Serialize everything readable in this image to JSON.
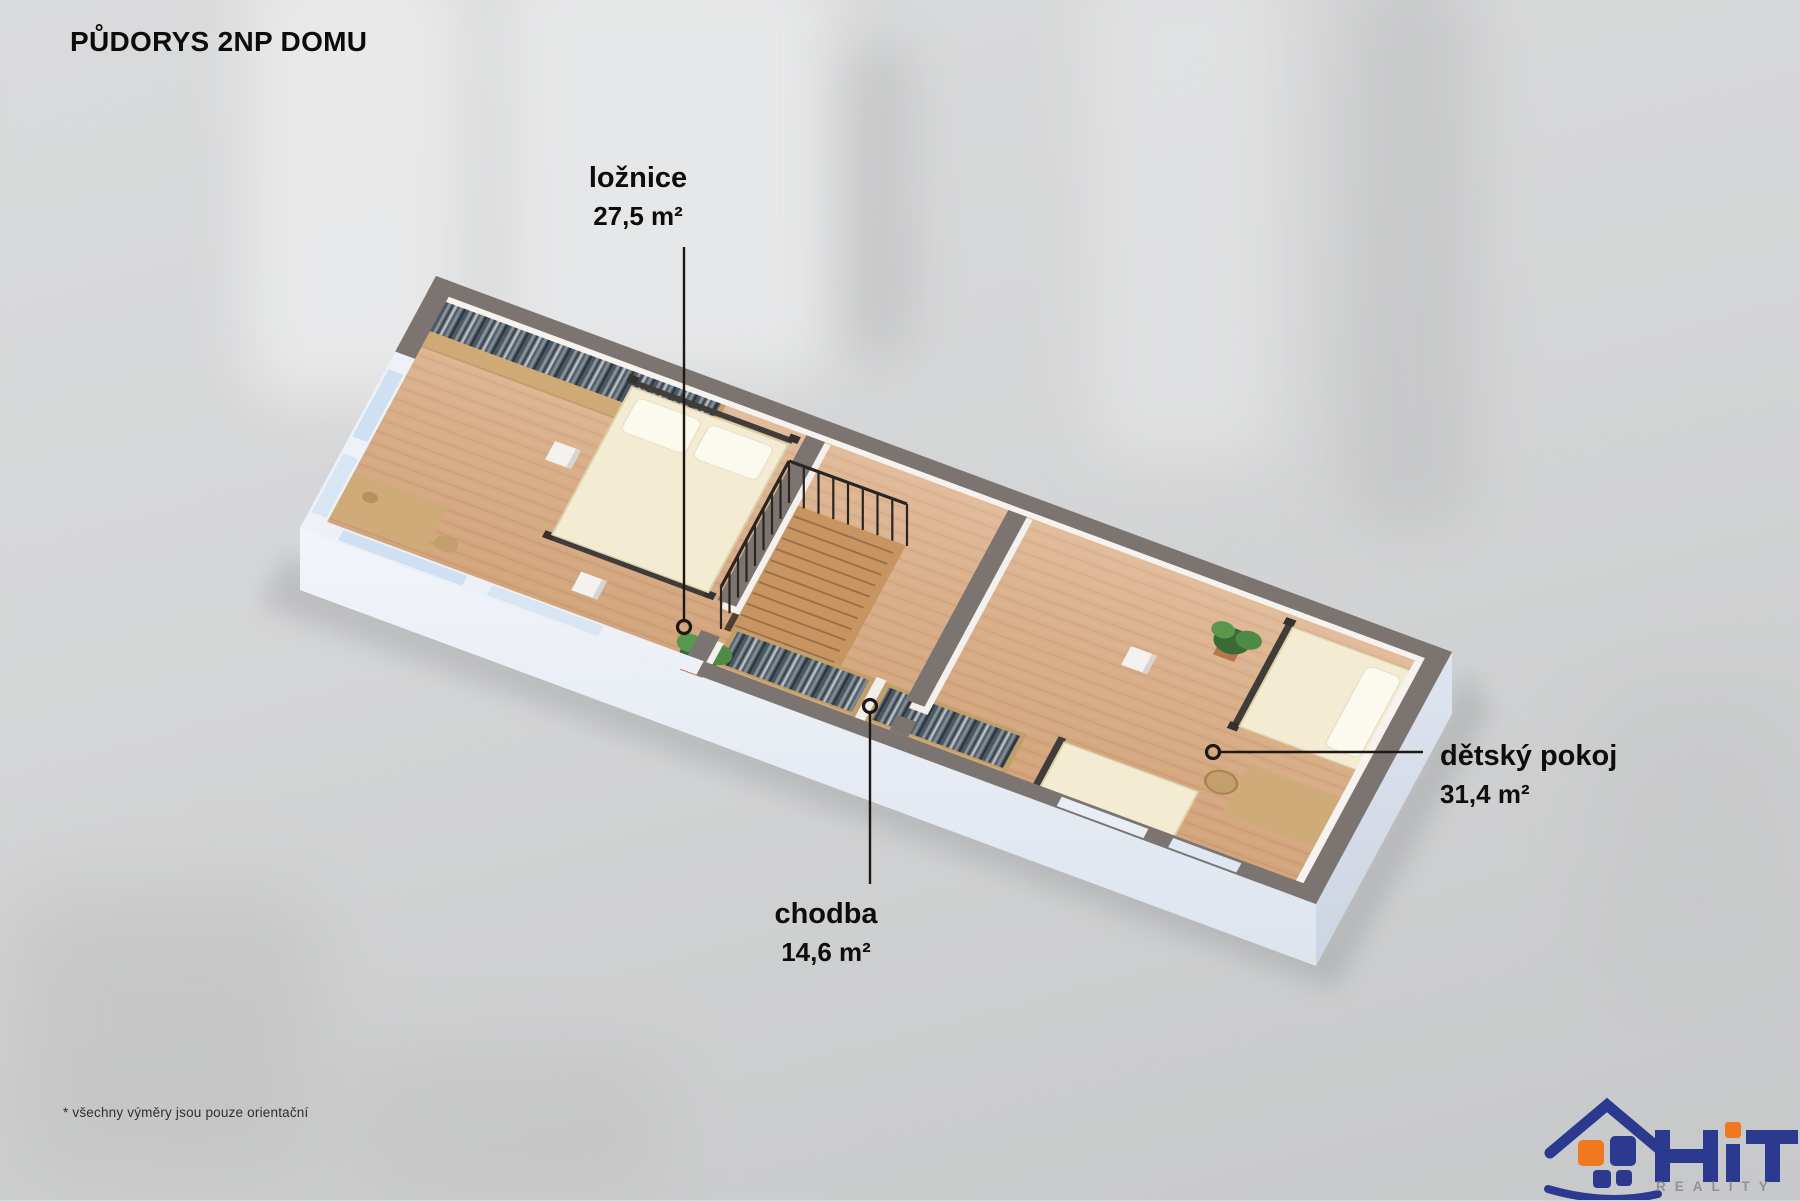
{
  "title": "PŮDORYS 2NP DOMU",
  "rooms": [
    {
      "name": "ložnice",
      "area": "27,5 m²"
    },
    {
      "name": "chodba",
      "area": "14,6 m²"
    },
    {
      "name": "dětský pokoj",
      "area": "31,4 m²"
    }
  ],
  "footnote": "* všechny výměry jsou pouze orientační",
  "logo": {
    "brand": "HiT",
    "subtitle": "REALITY"
  },
  "colors": {
    "accent_navy": "#2b3a8f",
    "accent_orange": "#f0791f",
    "wall_top": "#7b7470",
    "floor_wood": "#d9ab83",
    "slab": "#e9eef6",
    "label_text": "#0d0d0d"
  }
}
